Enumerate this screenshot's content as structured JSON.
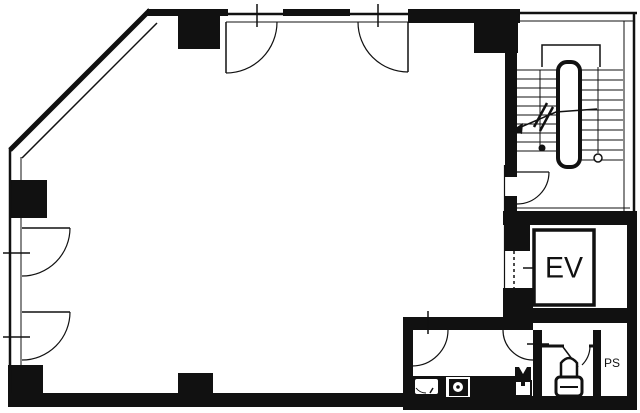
{
  "labels": {
    "elevator": "EV",
    "pipe_shaft": "PS"
  },
  "colors": {
    "ink": "#111111",
    "background": "#ffffff"
  }
}
